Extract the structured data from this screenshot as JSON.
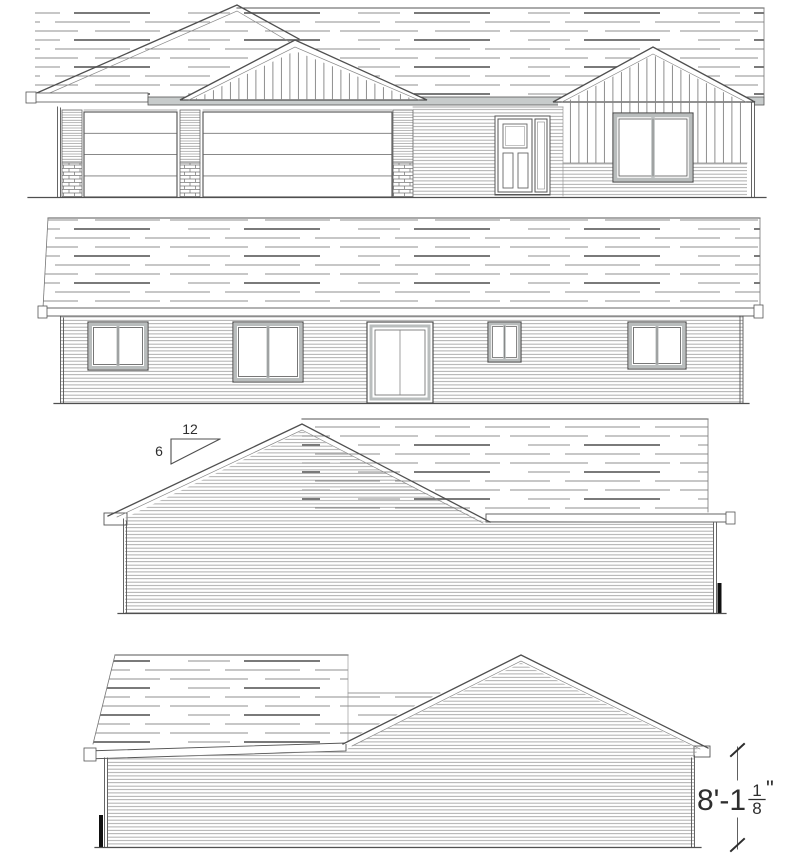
{
  "page": {
    "background": "#ffffff"
  },
  "palette": {
    "line": "#4f4f4f",
    "line_light": "#8f8f8f",
    "shingle_dash": "#8f8f8f",
    "shingle_dash_dark": "#666666",
    "fascia_gray": "#c7cbcb",
    "window_frame_gray": "#b9bdbd",
    "grade_marker_black": "#111111"
  },
  "annotations": {
    "pitch_marker": {
      "run_label": "12",
      "rise_label": "6"
    },
    "height_dimension": {
      "value_text": "8'-1",
      "fraction_numerator": "1",
      "fraction_denominator": "8",
      "unit_symbol": "\""
    }
  }
}
